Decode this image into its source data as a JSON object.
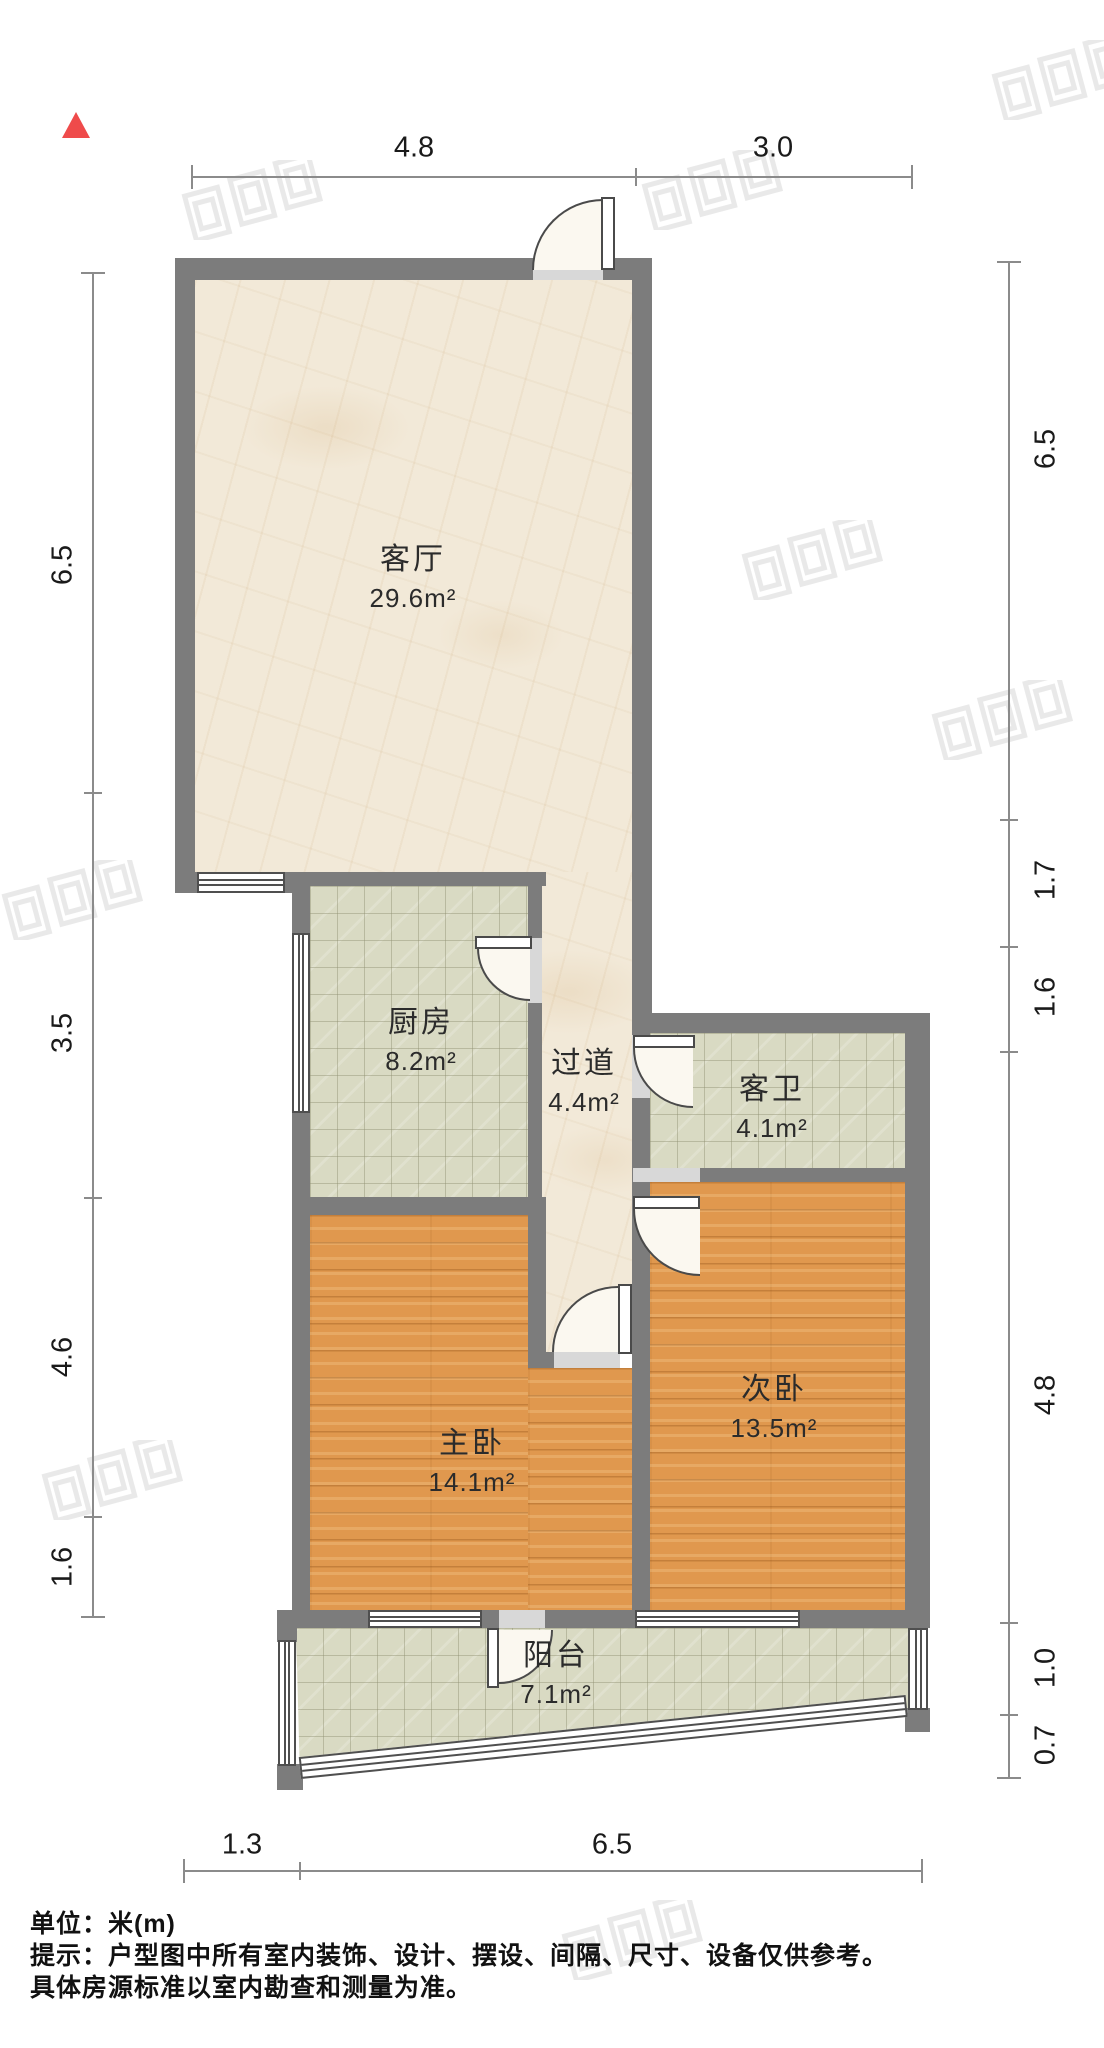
{
  "plan": {
    "type": "floor-plan",
    "north_indicator": "north-arrow"
  },
  "rooms": [
    {
      "name": "客厅",
      "area": "29.6m²"
    },
    {
      "name": "厨房",
      "area": "8.2m²"
    },
    {
      "name": "过道",
      "area": "4.4m²"
    },
    {
      "name": "客卫",
      "area": "4.1m²"
    },
    {
      "name": "主卧",
      "area": "14.1m²"
    },
    {
      "name": "次卧",
      "area": "13.5m²"
    },
    {
      "name": "阳台",
      "area": "7.1m²"
    }
  ],
  "dimensions": {
    "top": [
      "4.8",
      "3.0"
    ],
    "bottom": [
      "1.3",
      "6.5"
    ],
    "left": [
      "6.5",
      "3.5",
      "4.6",
      "1.6"
    ],
    "right": [
      "6.5",
      "1.7",
      "1.6",
      "4.8",
      "1.0",
      "0.7"
    ]
  },
  "footer": {
    "unit_line": "单位：米(m)",
    "tip_line1": "提示：户型图中所有室内装饰、设计、摆设、间隔、尺寸、设备仅供参考。",
    "tip_line2": "具体房源标准以室内勘查和测量为准。"
  },
  "colors": {
    "wall": "#7c7c7c",
    "north_arrow": "#ef4b4b",
    "wood_floor": "#e0984e",
    "tile_floor": "#d9dac3",
    "marble_floor": "#f2e9d8",
    "dimension_line": "#8b8b8b"
  }
}
